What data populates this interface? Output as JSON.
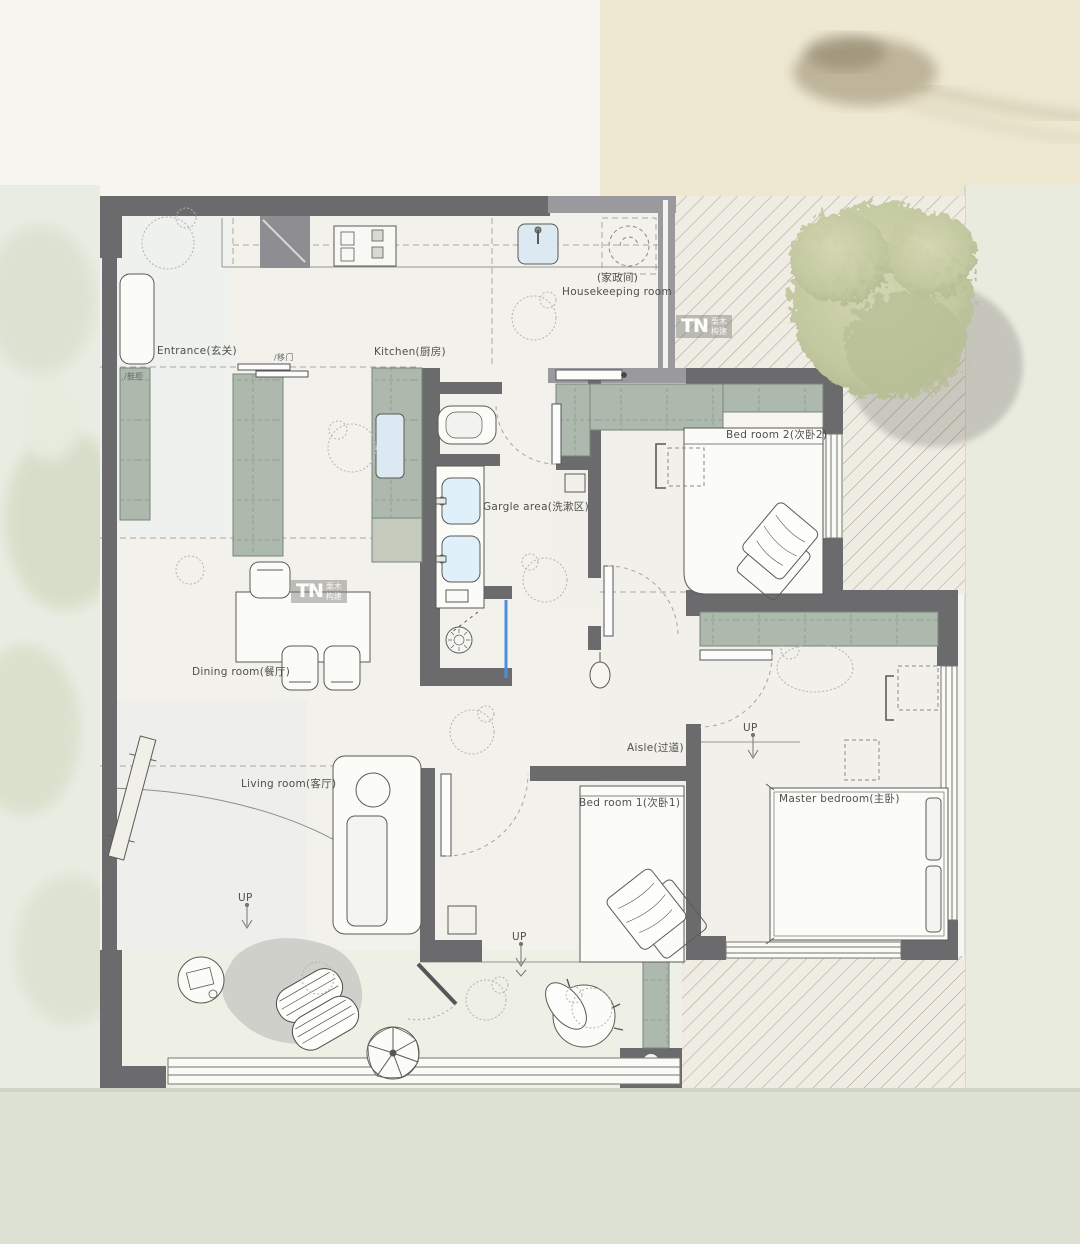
{
  "rooms": {
    "entrance": {
      "label": "Entrance(玄关)"
    },
    "kitchen": {
      "label": "Kitchen(厨房)"
    },
    "housekeeping": {
      "label_cn": "(家政间)",
      "label_en": "Housekeeping room"
    },
    "bedroom2": {
      "label": "Bed room 2(次卧2)"
    },
    "gargle": {
      "label": "Gargle area(洗漱区)"
    },
    "dining": {
      "label": "Dining room(餐厅)"
    },
    "living": {
      "label": "Living room(客厅)"
    },
    "aisle": {
      "label": "Aisle(过道)"
    },
    "bedroom1": {
      "label": "Bed room 1(次卧1)"
    },
    "master": {
      "label": "Master bedroom(主卧)"
    }
  },
  "annotations": {
    "up": "UP",
    "sliding_door_label": "/移门",
    "shoe_cabinet_label": "/鞋柜"
  },
  "watermark": {
    "logo": "TN",
    "cn_top": "栗木",
    "cn_bottom": "构建"
  },
  "colors": {
    "wall_dark": "#6b6b6e",
    "wall_light": "#9a9a9e",
    "cabinet_green": "#aeb9ae",
    "hatch_bg": "#efede3",
    "floor": "#f2f1eb",
    "glass_blue": "#4a90d9",
    "water_wash": "#ece4cc",
    "bottom_band": "#dce1d4"
  }
}
